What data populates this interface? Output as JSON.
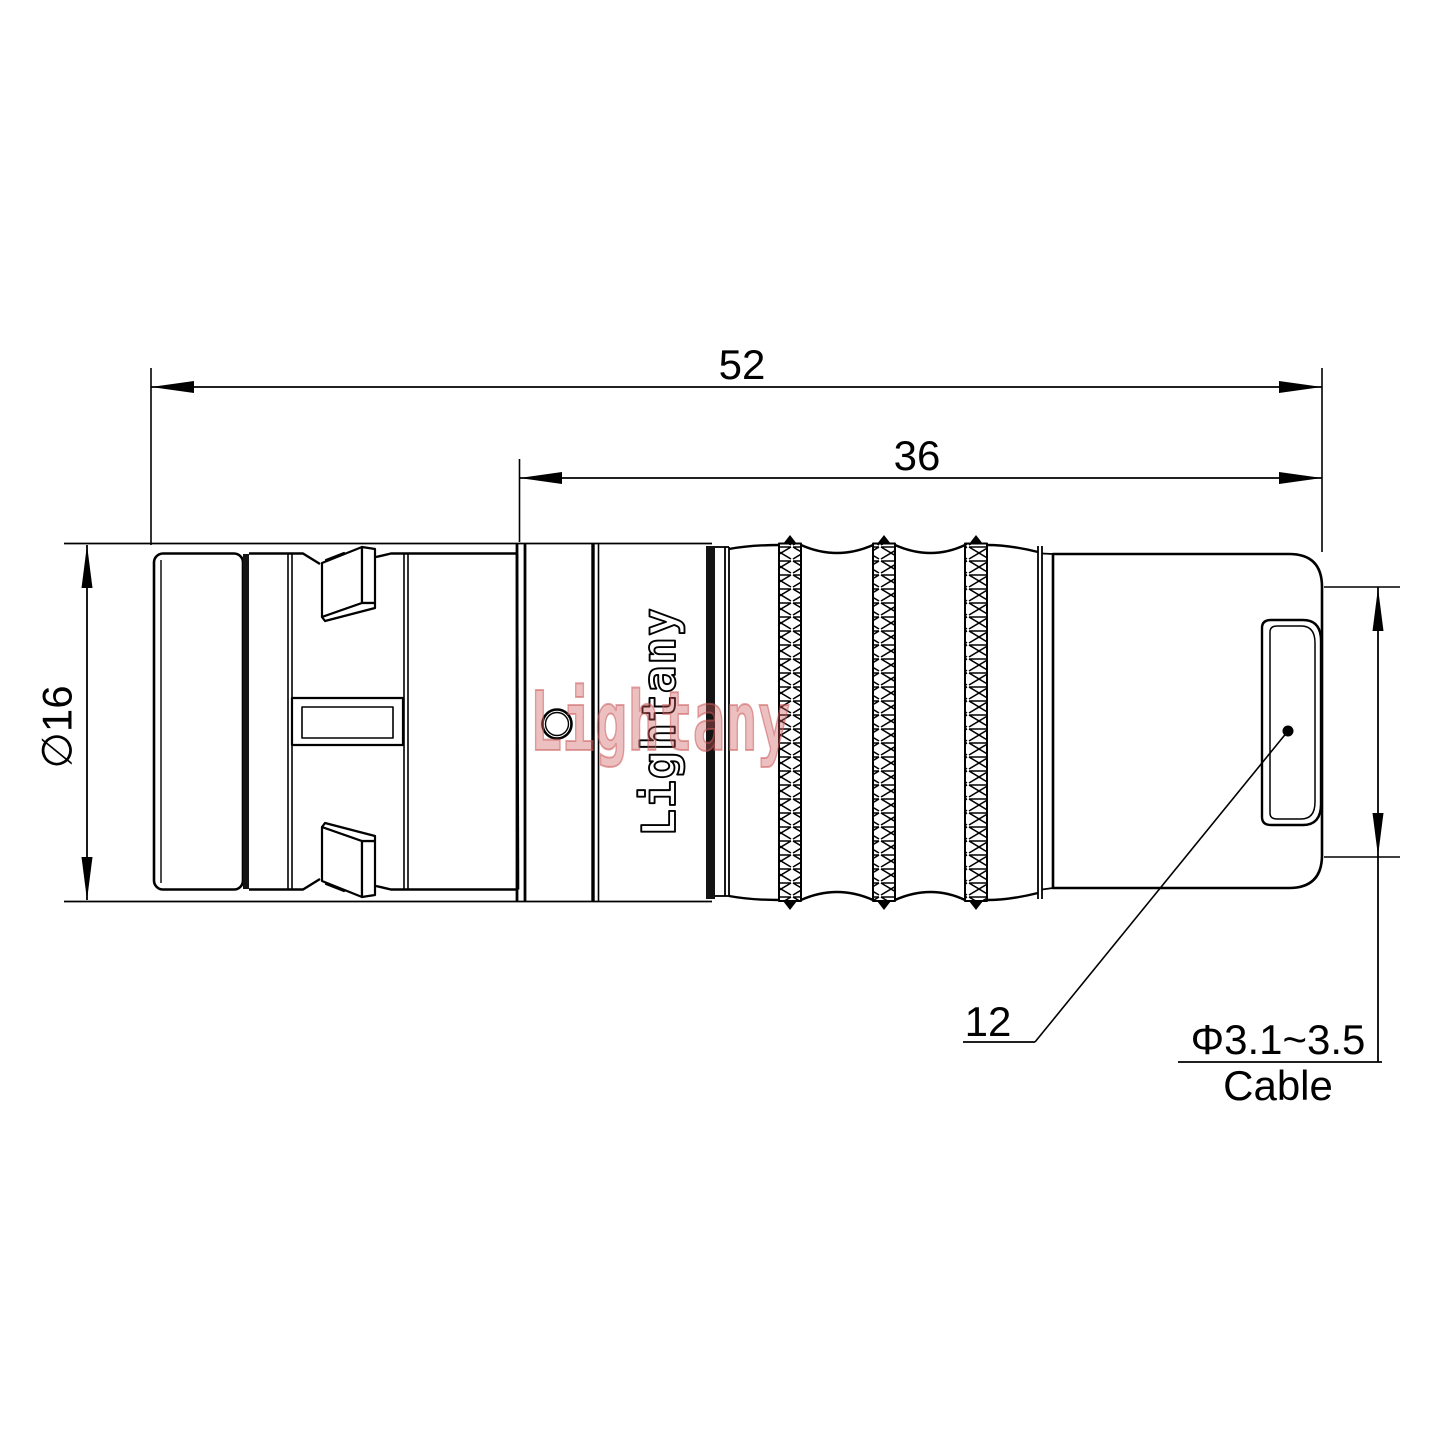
{
  "drawing": {
    "dimensions": {
      "overall_length": "52",
      "front_section_length": "36",
      "shell_diameter": "∅16",
      "boot_diameter": "12",
      "cable_range": "Φ3.1~3.5",
      "cable_word": "Cable"
    },
    "branding": {
      "logo_text": "Lightany",
      "watermark_text": "Lightany"
    },
    "colors": {
      "line": "#000000",
      "watermark": "#cc5a5a"
    }
  }
}
